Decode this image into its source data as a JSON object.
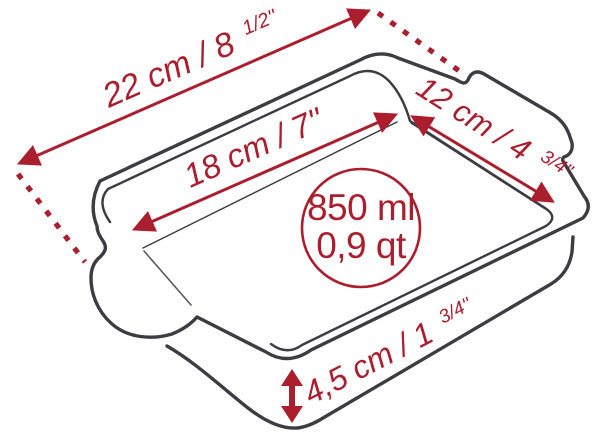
{
  "colors": {
    "accent": "#ab1e2e",
    "outline": "#3c3c42",
    "background": "#ffffff"
  },
  "capacity_badge": {
    "volume_metric": "850 ml",
    "volume_imperial": "0,9 qt"
  },
  "dimensions": {
    "outer_length": {
      "main": "22 cm / 8",
      "fraction": "1/2''"
    },
    "inner_length": {
      "main": "18 cm / 7''",
      "fraction": ""
    },
    "outer_width": {
      "main": "12 cm / 4",
      "fraction": "3/4''"
    },
    "wall_height": {
      "main": "4,5 cm / 1",
      "fraction": "3/4''"
    }
  }
}
